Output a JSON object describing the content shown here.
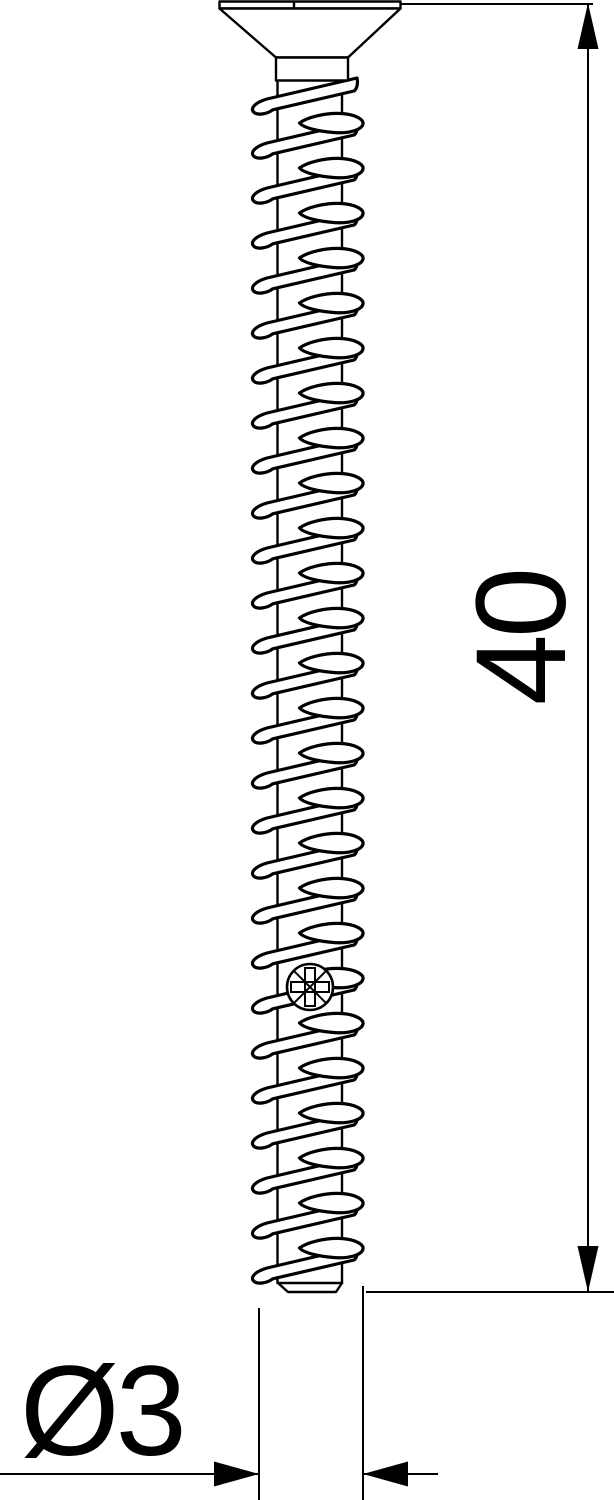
{
  "diagram": {
    "background_color": "#ffffff",
    "line_color": "#000000",
    "dimensions": {
      "length": {
        "label": "40"
      },
      "diameter": {
        "label": "Ø3"
      }
    },
    "features": {
      "head": "countersunk flat head",
      "drive": "pozidriv",
      "thread_visible_turns": 27
    }
  }
}
